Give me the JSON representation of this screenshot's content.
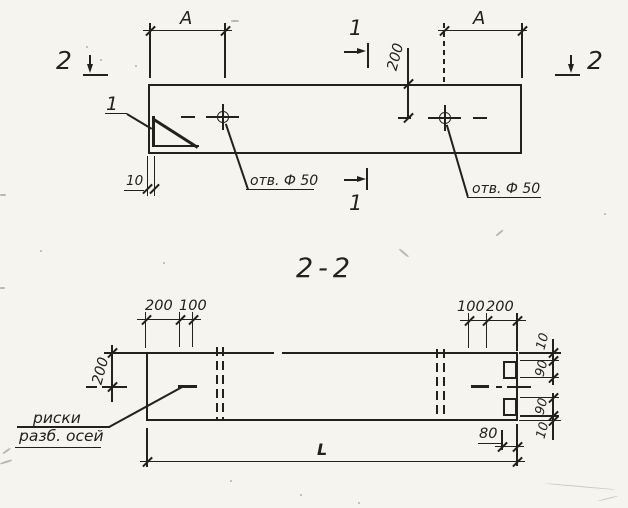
{
  "colors": {
    "ink": "#23211e",
    "paper": "#f5f4ef"
  },
  "plan_view": {
    "dim_a_left": "A",
    "dim_a_right": "A",
    "section1_top": "1",
    "section1_bottom": "1",
    "section2_left": "2",
    "section2_right": "2",
    "detail_ref": "1",
    "dim_edge": "10",
    "dim_hole_offset": "200",
    "hole_label_left": "отв. Ф 50",
    "hole_label_right": "отв. Ф 50"
  },
  "section_view": {
    "title": "2-2",
    "dim_left_200": "200",
    "dim_left_100": "100",
    "dim_right_100": "100",
    "dim_right_200": "200",
    "dim_height": "200",
    "chain": [
      "10",
      "90",
      "90",
      "10"
    ],
    "dim_80": "80",
    "dim_length": "L",
    "axis_note_line1": "риски",
    "axis_note_line2": "разб. осей"
  }
}
